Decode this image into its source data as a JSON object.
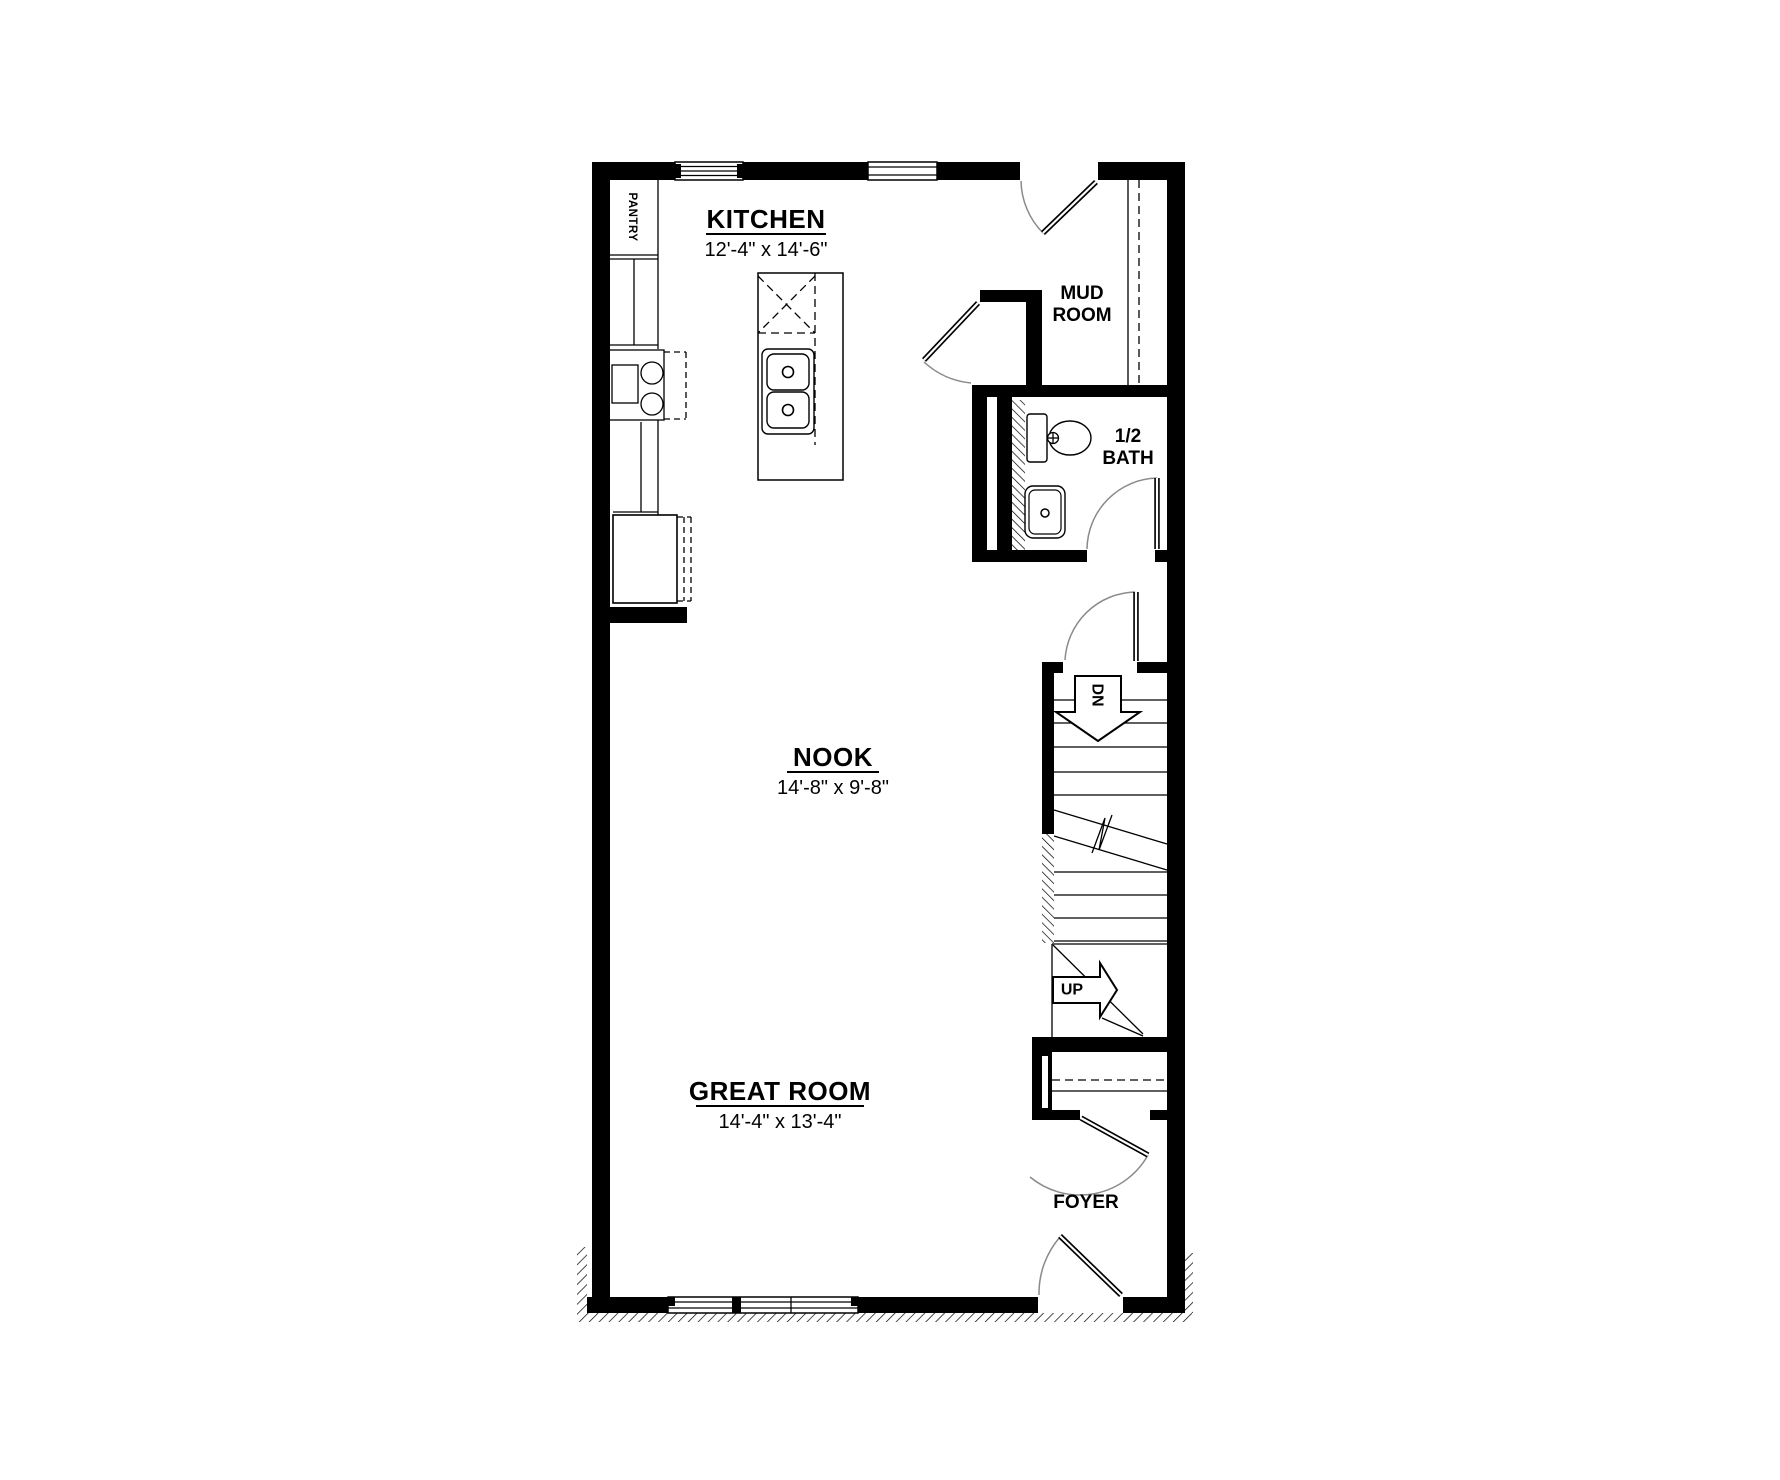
{
  "page": {
    "background": "#ffffff",
    "ink_color": "#000000",
    "door_arc_color": "#8a8a8a"
  },
  "rooms": {
    "kitchen": {
      "name": "KITCHEN",
      "dims": "12'-4\" x 14'-6\""
    },
    "nook": {
      "name": "NOOK",
      "dims": "14'-8\" x 9'-8\""
    },
    "great_room": {
      "name": "GREAT ROOM",
      "dims": "14'-4\" x 13'-4\""
    },
    "mud_room": {
      "line1": "MUD",
      "line2": "ROOM"
    },
    "half_bath": {
      "line1": "1/2",
      "line2": "BATH"
    },
    "foyer": {
      "name": "FOYER"
    },
    "pantry": {
      "name": "PANTRY"
    }
  },
  "stairs": {
    "down_label": "DN",
    "up_label": "UP"
  }
}
